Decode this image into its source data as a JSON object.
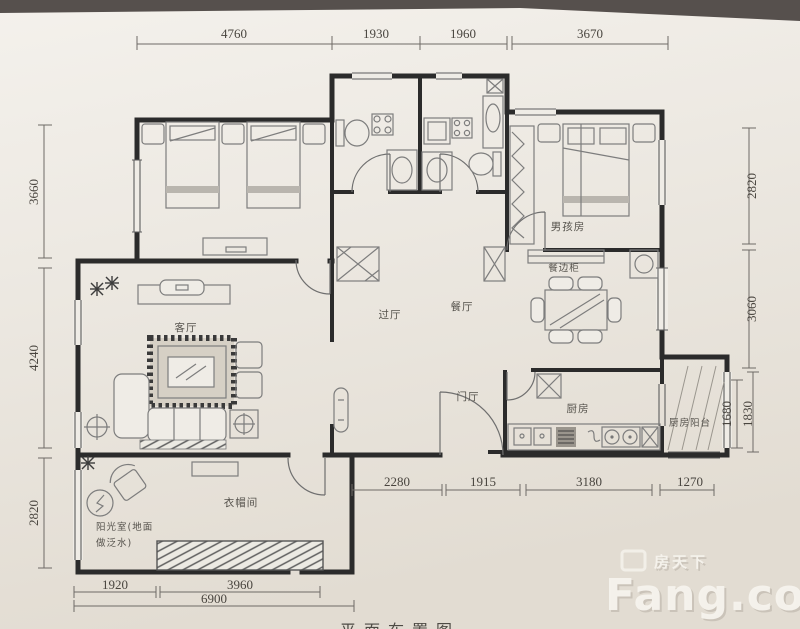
{
  "caption": "平面布置图",
  "watermark": {
    "brand_cn": "房天下",
    "brand_en": "Fang.com"
  },
  "rooms": {
    "boys_room": "男孩房",
    "sideboard": "餐边柜",
    "dining": "餐厅",
    "hall": "过厅",
    "living": "客厅",
    "foyer": "门厅",
    "kitchen": "厨房",
    "kitchen_balcony": "厨房阳台",
    "cloakroom": "衣帽间",
    "sunroom_line1": "阳光室(地面",
    "sunroom_line2": "做泛水)"
  },
  "dims": {
    "top": [
      "4760",
      "1930",
      "1960",
      "3670"
    ],
    "left": [
      "3660",
      "4240",
      "2820"
    ],
    "right": [
      "2820",
      "3060",
      "1680",
      "1830"
    ],
    "bottom": [
      "2280",
      "1915",
      "3180",
      "1270"
    ],
    "bottom_left": [
      "1920",
      "3960",
      "6900"
    ]
  },
  "colors": {
    "paper": "#ece8e1",
    "top_band": "#56504d",
    "wall": "#2b2b2b",
    "dim_line": "#6e6a66",
    "watermark": "#f7f4ee"
  }
}
